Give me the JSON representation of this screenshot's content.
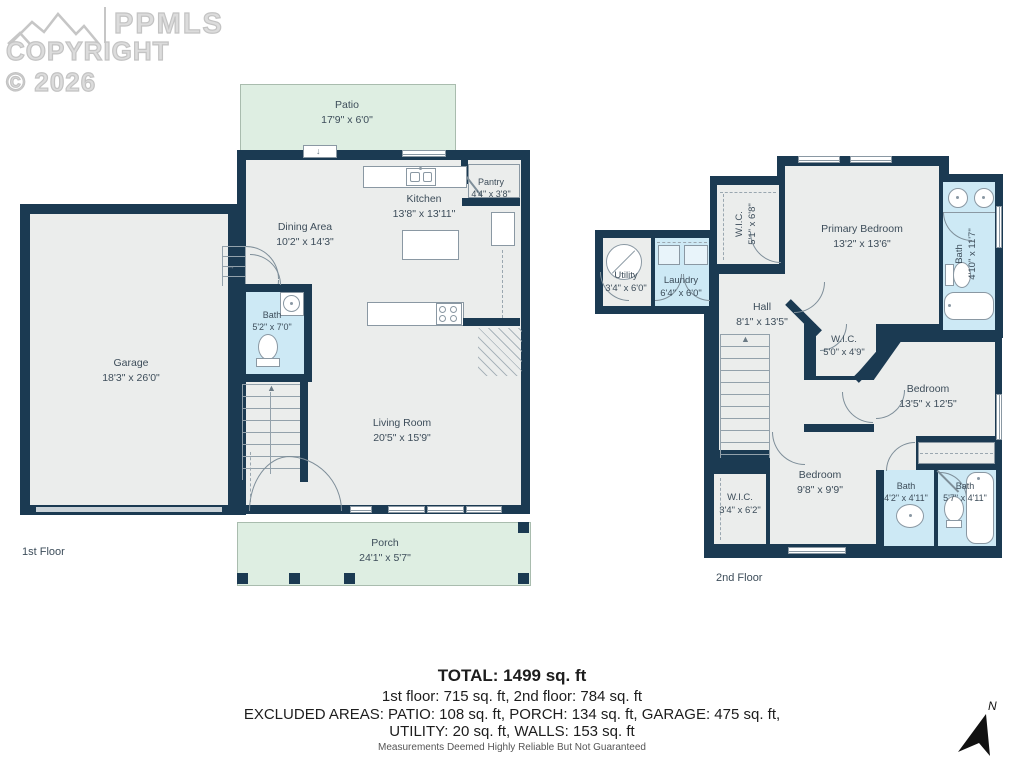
{
  "logo": {
    "brand": "PPMLS",
    "copyright": "COPYRIGHT © 2026"
  },
  "floor1": {
    "label": "1st Floor",
    "rooms": [
      {
        "name": "Patio",
        "dims": "17'9\" x 6'0\""
      },
      {
        "name": "Garage",
        "dims": "18'3\" x 26'0\""
      },
      {
        "name": "Dining Area",
        "dims": "10'2\" x 14'3\""
      },
      {
        "name": "Kitchen",
        "dims": "13'8\" x 13'11\""
      },
      {
        "name": "Pantry",
        "dims": "4'4\" x 3'8\""
      },
      {
        "name": "Bath",
        "dims": "5'2\" x 7'0\""
      },
      {
        "name": "Living Room",
        "dims": "20'5\" x 15'9\""
      },
      {
        "name": "Porch",
        "dims": "24'1\" x 5'7\""
      }
    ]
  },
  "floor2": {
    "label": "2nd Floor",
    "rooms": [
      {
        "name": "Utility",
        "dims": "3'4\" x 6'0\""
      },
      {
        "name": "Laundry",
        "dims": "6'4\" x 6'0\""
      },
      {
        "name": "W.I.C.",
        "dims": "5'1\" x 6'8\""
      },
      {
        "name": "Primary Bedroom",
        "dims": "13'2\" x 13'6\""
      },
      {
        "name": "Bath",
        "dims": "4'10\" x 11'7\""
      },
      {
        "name": "Hall",
        "dims": "8'1\" x 13'5\""
      },
      {
        "name": "W.I.C.",
        "dims": "5'0\" x 4'9\""
      },
      {
        "name": "Bedroom",
        "dims": "13'5\" x 12'5\""
      },
      {
        "name": "W.I.C.",
        "dims": "3'4\" x 6'2\""
      },
      {
        "name": "Bedroom",
        "dims": "9'8\" x 9'9\""
      },
      {
        "name": "Bath",
        "dims": "4'2\" x 4'11\""
      },
      {
        "name": "Bath",
        "dims": "5'7\" x 4'11\""
      }
    ]
  },
  "summary": {
    "total": "TOTAL: 1499 sq. ft",
    "floors": "1st floor: 715 sq. ft, 2nd floor: 784 sq. ft",
    "excluded_line1": "EXCLUDED AREAS: PATIO: 108 sq. ft, PORCH: 134 sq. ft, GARAGE: 475 sq. ft,",
    "excluded_line2": "UTILITY: 20 sq. ft, WALLS: 153 sq. ft",
    "disclaimer": "Measurements Deemed Highly Reliable But Not Guaranteed"
  },
  "compass": {
    "label": "N"
  },
  "colors": {
    "wall": "#1b3a52",
    "floor": "#ebedec",
    "wet_room": "#cde9f5",
    "outdoor": "#deeee2",
    "label_text": "#3d4d5a"
  }
}
